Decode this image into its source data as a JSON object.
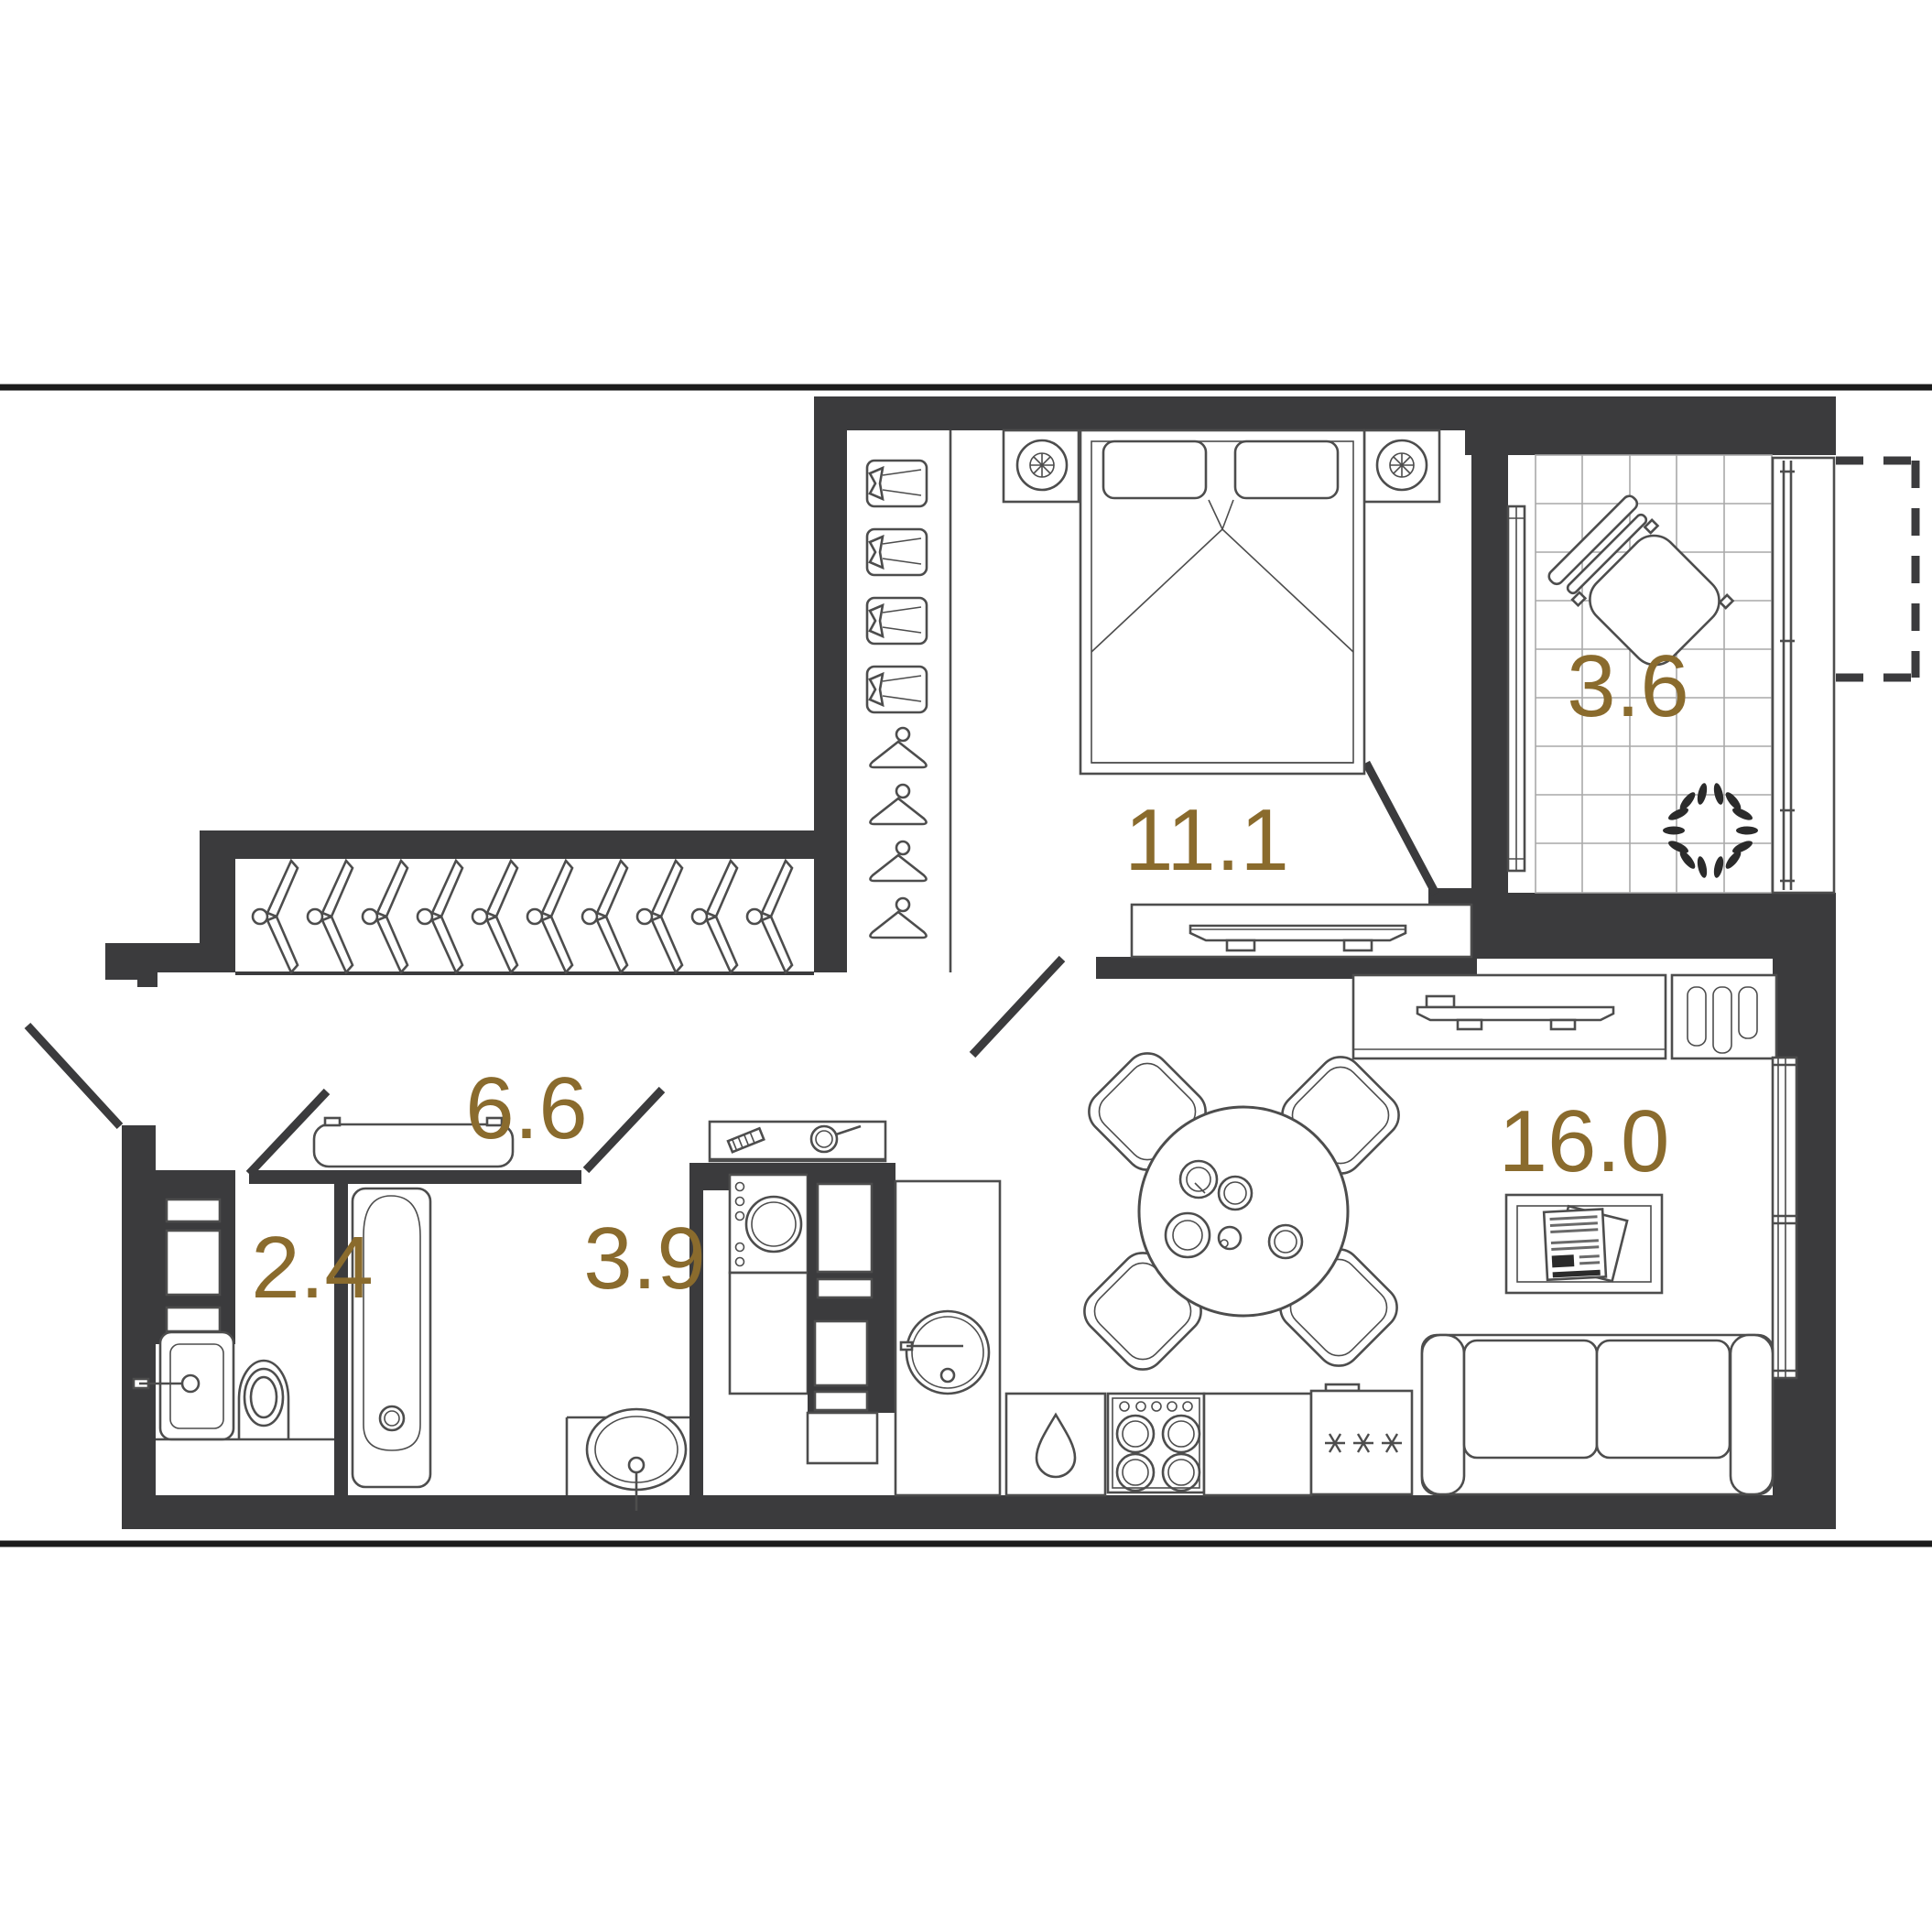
{
  "plan": {
    "type": "apartment-floor-plan",
    "wall_color": "#3b3b3d",
    "label_color": "#8a6b2d",
    "background": "#ffffff",
    "rooms": [
      {
        "id": "wc",
        "area": "2.4"
      },
      {
        "id": "bathroom",
        "area": "3.9"
      },
      {
        "id": "hallway",
        "area": "6.6"
      },
      {
        "id": "bedroom",
        "area": "11.1"
      },
      {
        "id": "balcony",
        "area": "3.6"
      },
      {
        "id": "kitchen-living",
        "area": "16.0"
      }
    ],
    "icons": [
      "double-bed-icon",
      "nightstand-lamp-icon",
      "wardrobe-shelf-icon",
      "hanger-icon",
      "tv-icon",
      "lounge-chair-icon",
      "plant-icon",
      "bench-icon",
      "sink-icon",
      "toilet-icon",
      "bathtub-icon",
      "washing-machine-icon",
      "kitchen-sink-icon",
      "stove-icon",
      "fridge-snowflake-icon",
      "dining-table-icon",
      "chair-icon",
      "sofa-icon",
      "rug-newspaper-icon",
      "window-glazing-icon"
    ]
  }
}
